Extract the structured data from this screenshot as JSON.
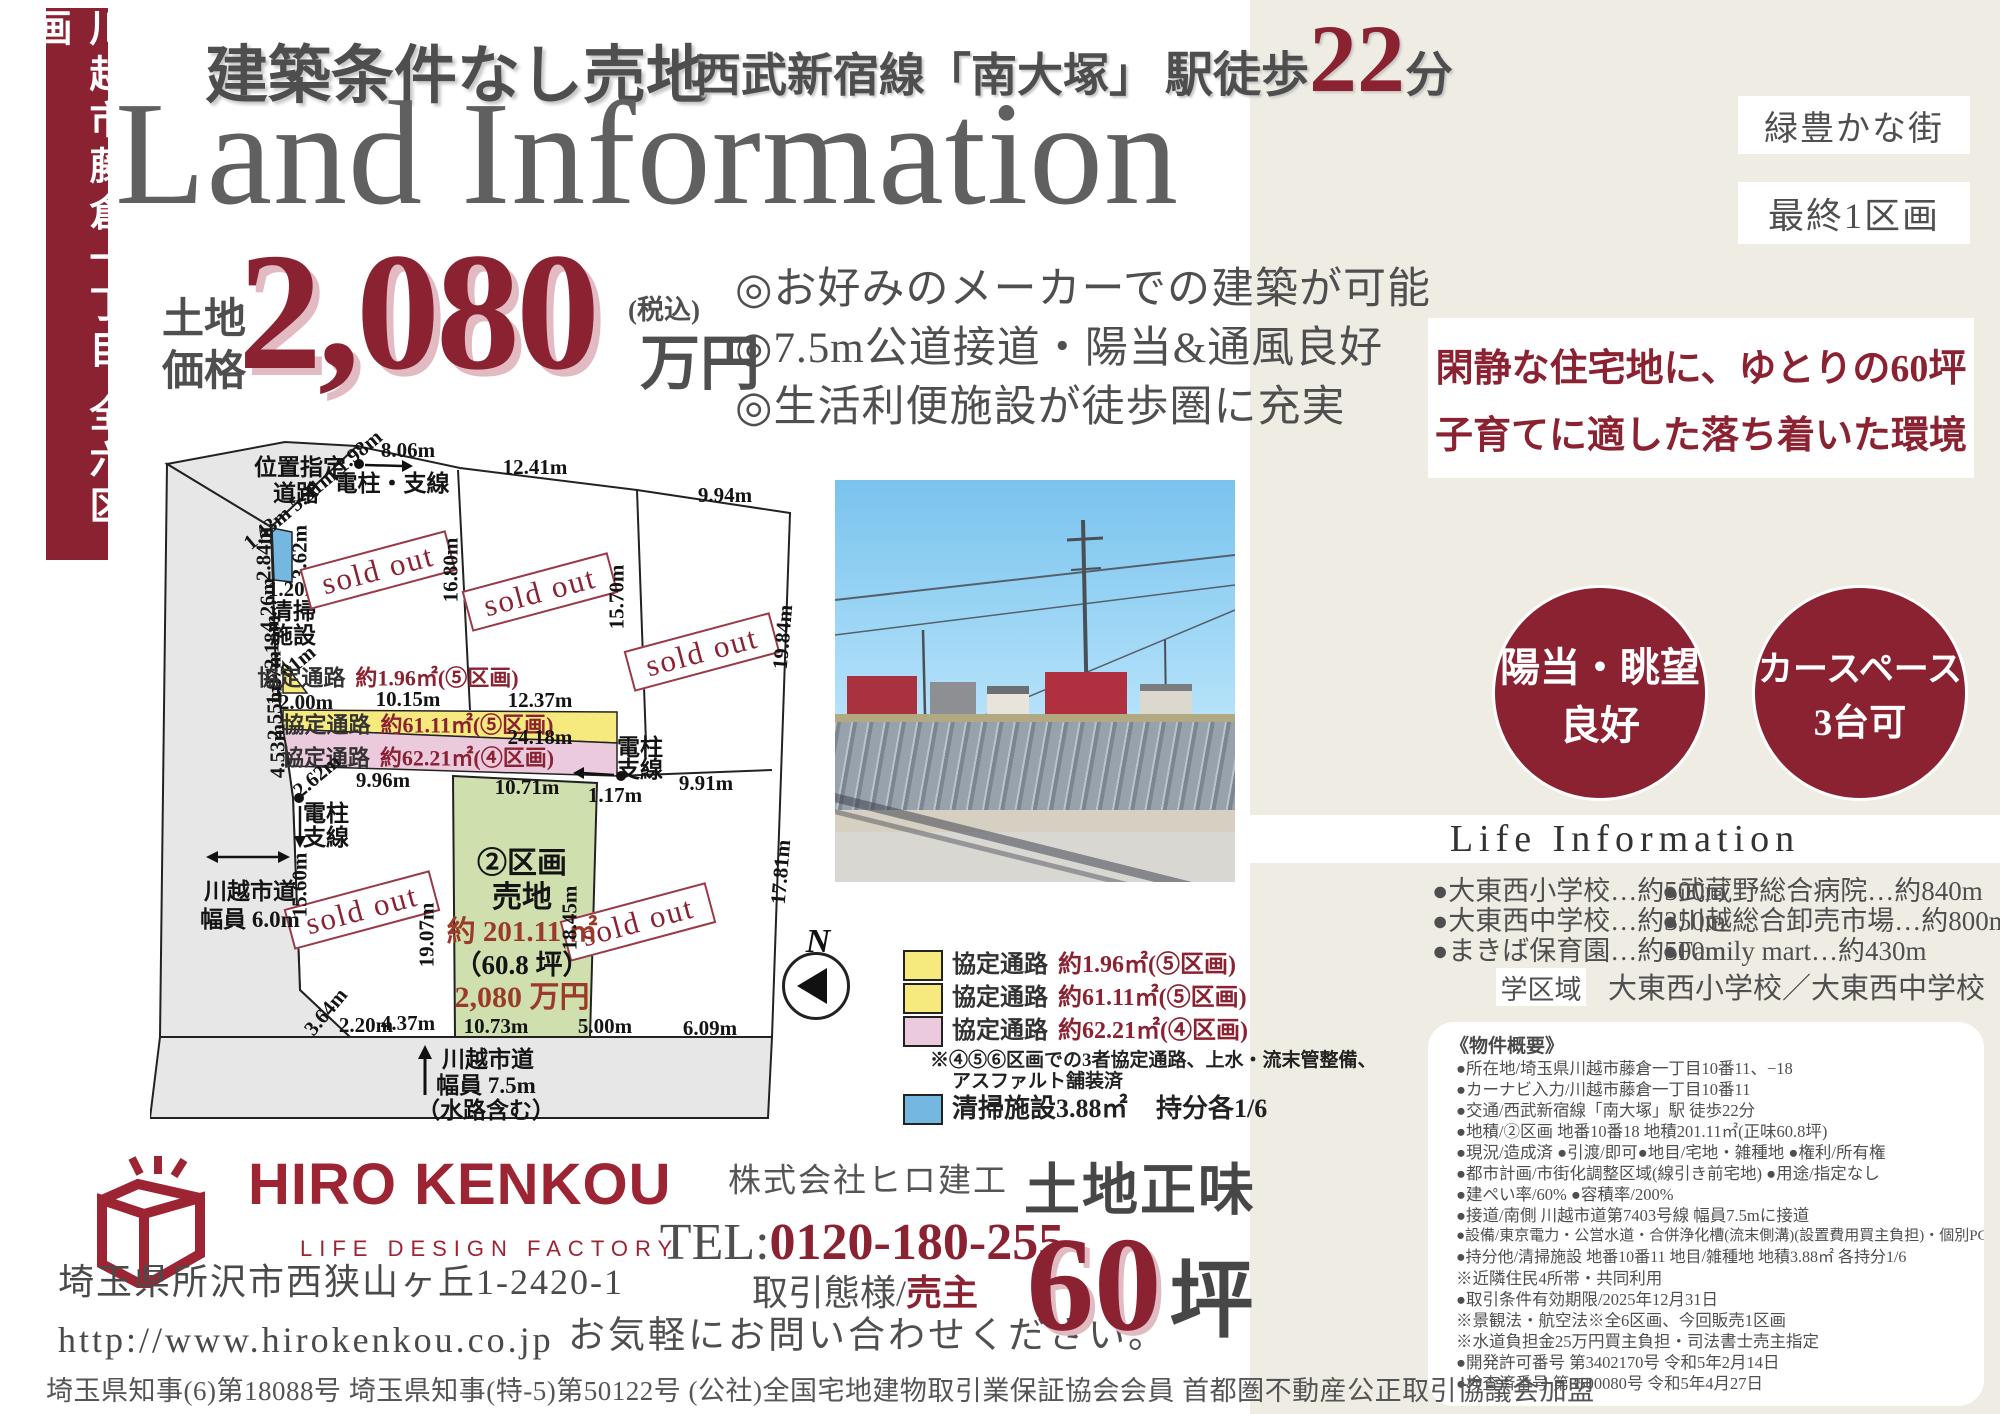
{
  "colors": {
    "accent": "#8b2232",
    "beige": "#efece3",
    "yellow": "#f6e97e",
    "pink": "#eccade",
    "green": "#cfdfae",
    "blue": "#74b8e2",
    "road_gray": "#e7e7e7"
  },
  "banner": {
    "text": "川越市藤倉一丁目 全六区画"
  },
  "header": {
    "condition": "建築条件なし売地",
    "line_prefix": "西武新宿線「南大塚」",
    "walk_label": "駅徒歩",
    "walk_minutes": "22",
    "walk_unit": "分",
    "title": "Land Information"
  },
  "price": {
    "label1": "土地",
    "label2": "価格",
    "amount": "2,080",
    "tax": "(税込)",
    "unit": "万円"
  },
  "bullets": [
    "◎お好みのメーカーでの建築が可能",
    "◎7.5m公道接道・陽当&通風良好",
    "◎生活利便施設が徒歩圏に充実"
  ],
  "map": {
    "road_top1": "位置指定",
    "road_top2": "道路",
    "diag_dims": "1.43m 5.31m 1.98m",
    "pole_top": "電柱・支線",
    "pole1": "電柱",
    "pole2": "支線",
    "sold": "sold out",
    "dim_8_06": "8.06m",
    "dim_12_41": "12.41m",
    "dim_9_94": "9.94m",
    "dim_3_62": "3.62m",
    "dim_2_84": "2.84m",
    "dim_1_20": "1.20m",
    "clean1": "清掃",
    "clean2": "施設",
    "dim_4_26": "4.26m",
    "dim_16_80": "16.80m",
    "dim_15_70": "15.70m",
    "dim_19_84": "19.84m",
    "dim_2_18": "2.18m",
    "dim_1_97": "1.97m",
    "dim_3_01": "3.01m",
    "passage1_label": "協定通路",
    "passage1_value": "約1.96㎡(⑤区画)",
    "dim_10_15": "10.15m",
    "dim_2_00": "2.00m",
    "dim_12_37": "12.37m",
    "passage2_label": "協定通路",
    "passage2_value": "約61.11㎡(⑤区画)",
    "dim_24_18": "24.18m",
    "dim_2_55": "2.55m",
    "passage3_label": "協定通路",
    "passage3_value": "約62.21㎡(④区画)",
    "dim_4_53": "4.53m",
    "dim_9_96": "9.96m",
    "dim_10_71": "10.71m",
    "dim_1_17": "1.17m",
    "dim_9_91": "9.91m",
    "dim_2_62": "2.62m",
    "dim_15_60": "15.60m",
    "road_left1": "川越市道",
    "road_left2": "幅員 6.0m",
    "lot": {
      "no": "②区画",
      "type": "売地",
      "area": "約 201.11 ㎡",
      "tsubo": "（60.8 坪）",
      "price": "2,080 万円"
    },
    "dim_19_07": "19.07m",
    "dim_18_45": "18.45m",
    "dim_17_81": "17.81m",
    "dim_3_64": "3.64m",
    "dim_2_20": "2.20m",
    "dim_4_37": "4.37m",
    "dim_10_73": "10.73m",
    "dim_5_00": "5.00m",
    "dim_6_09": "6.09m",
    "road_bottom1": "川越市道",
    "road_bottom2": "幅員 7.5m",
    "road_bottom3": "（水路含む）",
    "compass_n": "N"
  },
  "legend": {
    "items": [
      {
        "label": "協定通路",
        "value": "約1.96㎡(⑤区画)"
      },
      {
        "label": "協定通路",
        "value": "約61.11㎡(⑤区画)"
      },
      {
        "label": "協定通路",
        "value": "約62.21㎡(④区画)"
      }
    ],
    "note1": "※④⑤⑥区画での3者協定通路、上水・流末管整備、",
    "note2": "アスファルト舗装済",
    "cleaning": "清掃施設3.88㎡",
    "share": "持分各1/6"
  },
  "sidebar": {
    "pill1": "緑豊かな街",
    "pill2": "最終1区画",
    "catch1": "閑静な住宅地に、ゆとりの60坪",
    "catch2": "子育てに適した落ち着いた環境",
    "circle1a": "陽当・眺望",
    "circle1b": "良好",
    "circle2a": "カースペース",
    "circle2b": "3台可",
    "life_title": "Life Information",
    "facilities_left": [
      "●大東西小学校…約500m",
      "●大東西中学校…約350m",
      "●まきば保育園…約500m"
    ],
    "facilities_right": [
      "●武蔵野総合病院…約840m",
      "●川越総合卸売市場…約800m",
      "●Family mart…約430m"
    ],
    "district_label": "学区域",
    "district_value": "大東西小学校／大東西中学校",
    "overview_title": "《物件概要》",
    "overview_lines": [
      "●所在地/埼玉県川越市藤倉一丁目10番11、−18",
      "●カーナビ入力/川越市藤倉一丁目10番11",
      "●交通/西武新宿線「南大塚」駅 徒歩22分",
      "●地積/②区画 地番10番18 地積201.11㎡(正味60.8坪)",
      "●現況/造成済 ●引渡/即可●地目/宅地・雑種地 ●権利/所有権",
      "●都市計画/市街化調整区域(線引き前宅地) ●用途/指定なし",
      "●建ぺい率/60% ●容積率/200%",
      "●接道/南側 川越市道第7403号線 幅員7.5mに接道",
      "●設備/東京電力・公営水道・合併浄化槽(流末側溝)(設置費用買主負担)・個別PG",
      "●持分他/清掃施設 地番10番11 地目/雑種地 地積3.88㎡ 各持分1/6",
      "※近隣住民4所帯・共同利用",
      "●取引条件有効期限/2025年12月31日",
      "※景観法・航空法※全6区画、今回販売1区画",
      "※水道負担金25万円買主負担・司法書士売主指定",
      "●開発許可番号 第3402170号 令和5年2月14日",
      "●検査済番号 第3500080号 令和5年4月27日"
    ]
  },
  "company": {
    "name": "HIRO KENKOU",
    "tagline": "LIFE DESIGN FACTORY",
    "address": "埼玉県所沢市西狭山ヶ丘1-2420-1",
    "url": "http://www.hirokenkou.co.jp"
  },
  "contact": {
    "corp": "株式会社ヒロ建工",
    "tel_label": "TEL:",
    "tel": "0120-180-255",
    "deal_label": "取引態様/",
    "deal_value": "売主",
    "message": "お気軽にお問い合わせください。"
  },
  "net_area": {
    "label": "土地正味",
    "value": "60",
    "unit": "坪"
  },
  "footer": {
    "license": "埼玉県知事(6)第18088号 埼玉県知事(特-5)第50122号 (公社)全国宅地建物取引業保証協会会員 首都圏不動産公正取引協議会加盟"
  }
}
